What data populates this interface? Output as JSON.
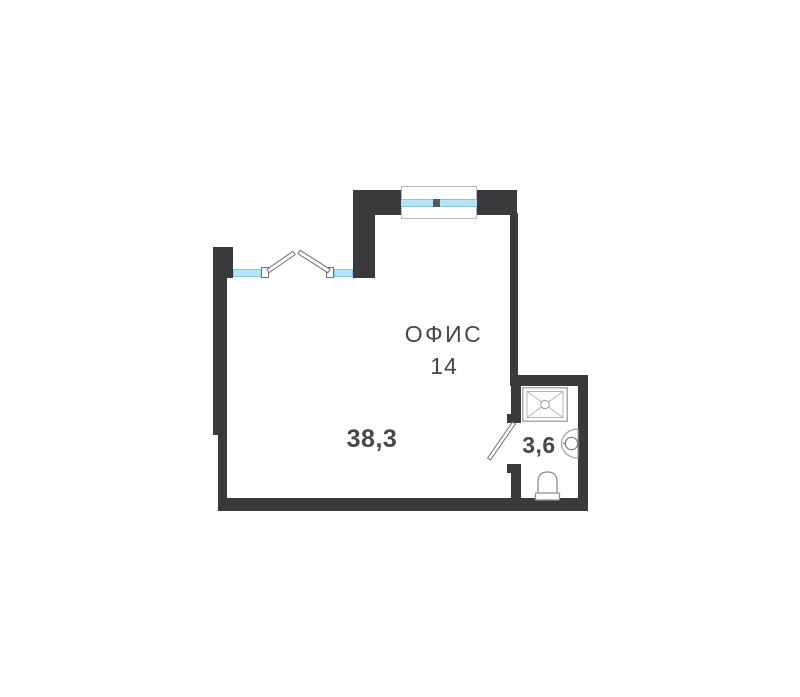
{
  "plan": {
    "room": {
      "name": "ОФИС",
      "number": "14"
    },
    "areas": {
      "office": "38,3",
      "bathroom": "3,6"
    },
    "colors": {
      "wall": "#3a3a3c",
      "glass_fill": "#b5e3f7",
      "glass_edge": "#7cc9ec",
      "fixture_line": "#a3a3a3",
      "text": "#47474a",
      "background": "#ffffff"
    },
    "fixtures": {
      "shower": "shower-tray-icon",
      "sink": "washbasin-icon",
      "toilet": "toilet-icon",
      "door": "door-swing-icon",
      "window_top": "window-glazing-icon",
      "window_left": "open-casement-window-icon"
    }
  }
}
